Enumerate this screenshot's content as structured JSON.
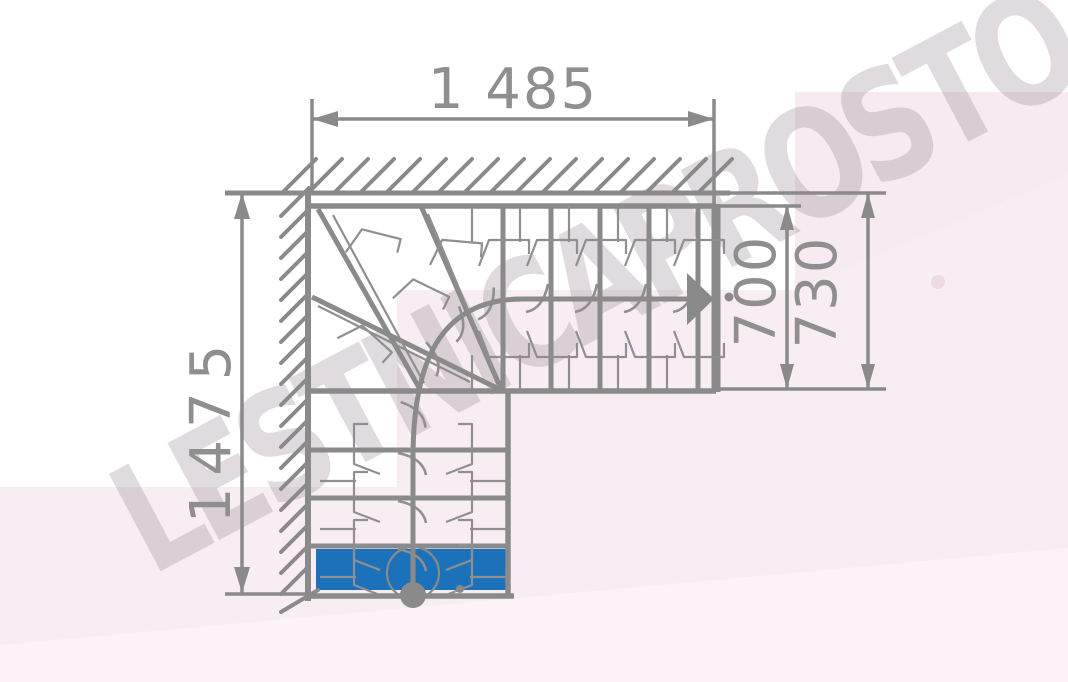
{
  "dimensions": {
    "width_top": "1 485",
    "height_left": "1475",
    "flight_width_inner": "700",
    "flight_width_outer": "730"
  },
  "watermark": "LESTNICAPROSTO.RU",
  "colors": {
    "line": "#8a8a8a",
    "text": "#8f8f8f",
    "first_step": "#1c72ba",
    "pink_bg": "#f8edf3",
    "pink_bg_light": "#fbf3f8",
    "watermark": "#968c93"
  }
}
